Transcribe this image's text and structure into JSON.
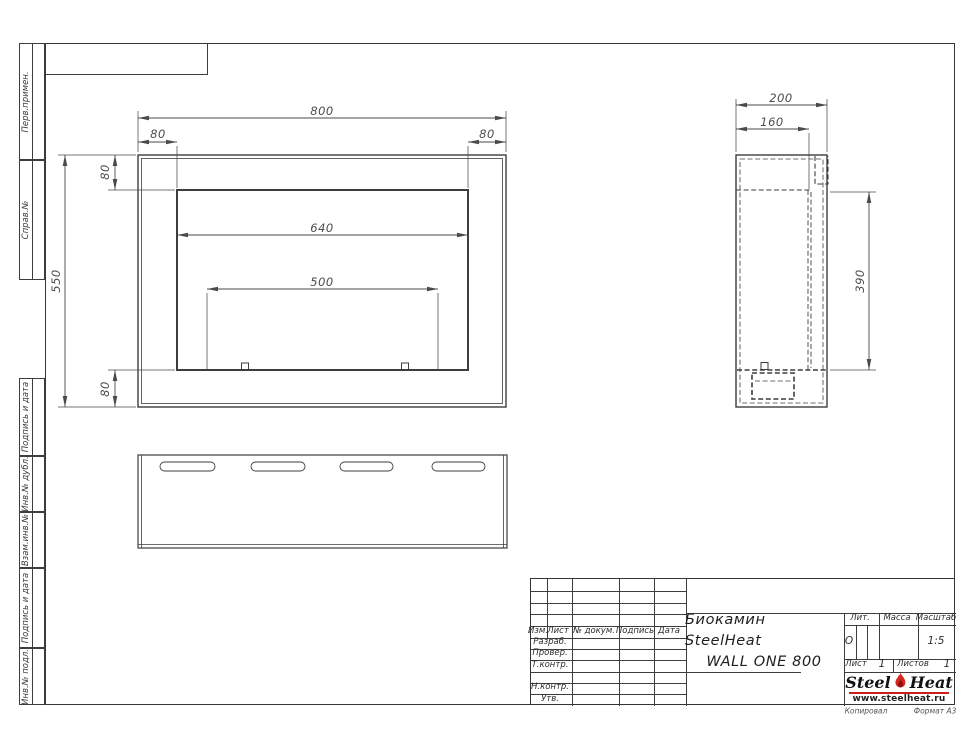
{
  "colors": {
    "line": "#3d3d3d",
    "dim_text": "#4d4d4d",
    "accent_red": "#cc1f1a"
  },
  "sidebar": {
    "labels": [
      "Перв.примен.",
      "Справ.№",
      "Подпись и дата",
      "Инв.№ дубл.",
      "Взам.инв.№",
      "Подпись и дата",
      "Инв.№ подл."
    ]
  },
  "views": {
    "front": {
      "dim_total_width": "800",
      "dim_flange_left": "80",
      "dim_flange_right": "80",
      "dim_flange_top": "80",
      "dim_total_height": "550",
      "dim_flange_bottom": "80",
      "dim_opening_width": "640",
      "dim_burner_width": "500"
    },
    "side": {
      "dim_total_depth": "200",
      "dim_inner_depth": "160",
      "dim_cavity_height": "390"
    }
  },
  "title_block": {
    "cols": {
      "izm": "Изм.",
      "list": "Лист",
      "doc": "№ докум.",
      "sign": "Подпись",
      "date": "Дата"
    },
    "rows": {
      "razrab": "Разраб.",
      "prover": "Провер.",
      "tkontr": "Т.контр.",
      "nkontr": "Н.контр.",
      "utv": "Утв."
    },
    "title_line1": "Биокамин SteelHeat",
    "title_line2": "WALL ONE 800",
    "lit_label": "Лит.",
    "lit_value": "О",
    "mass_label": "Масса",
    "scale_label": "Масштаб",
    "scale_value": "1:5",
    "sheet_label": "Лист",
    "sheet_num": "1",
    "sheets_label": "Листов",
    "sheets_num": "1"
  },
  "logo": {
    "steel": "Steel",
    "heat": "Heat",
    "url": "www.steelheat.ru"
  },
  "footer": {
    "left": "Копировал",
    "right": "Формат А3"
  }
}
